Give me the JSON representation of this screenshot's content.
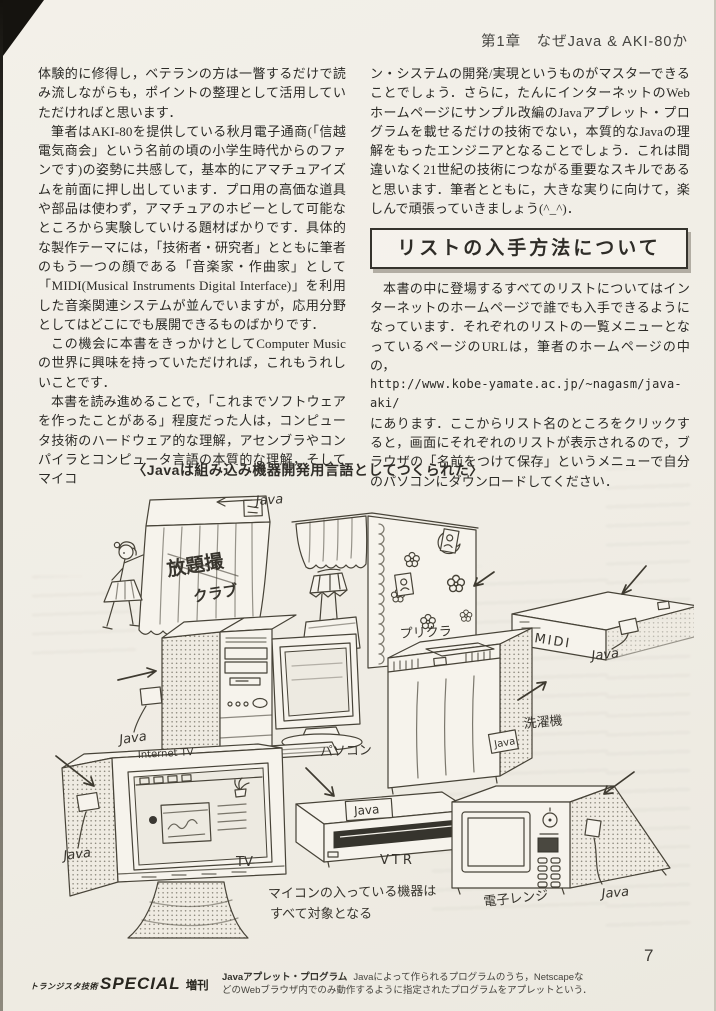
{
  "header": {
    "chapter": "第1章　なぜJava & AKI-80か"
  },
  "left_column": {
    "p1": "体験的に修得し，ベテランの方は一瞥するだけで読み流しながらも，ポイントの整理として活用していただければと思います．",
    "p2": "筆者はAKI-80を提供している秋月電子通商(「信越電気商会」という名前の頃の小学生時代からのファンです)の姿勢に共感して，基本的にアマチュアイズムを前面に押し出しています．プロ用の高価な道具や部品は使わず，アマチュアのホビーとして可能なところから実験していける題材ばかりです．具体的な製作テーマには，「技術者・研究者」とともに筆者のもう一つの顔である「音楽家・作曲家」として「MIDI(Musical Instruments Digital Interface)」を利用した音楽関連システムが並んでいますが，応用分野としてはどこにでも展開できるものばかりです．",
    "p3": "この機会に本書をきっかけとしてComputer Musicの世界に興味を持っていただければ，これもうれしいことです．",
    "p4": "本書を読み進めることで，「これまでソフトウェアを作ったことがある」程度だった人は，コンピュータ技術のハードウェア的な理解，アセンブラやコンパイラとコンピュータ言語の本質的な理解，そしてマイコ"
  },
  "right_column": {
    "p1": "ン・システムの開発/実現というものがマスターできることでしょう．さらに，たんにインターネットのWebホームページにサンプル改編のJavaアプレット・プログラムを載せるだけの技術でない，本質的なJavaの理解をもったエンジニアとなることでしょう．これは間違いなく21世紀の技術につながる重要なスキルであると思います．筆者とともに，大きな実りに向けて，楽しんで頑張っていきましょう(^_^)．",
    "box_title": "リストの入手方法について",
    "p2": "本書の中に登場するすべてのリストについてはインターネットのホームページで誰でも入手できるようになっています．それぞれのリストの一覧メニューとなっているページのURLは，筆者のホームページの中の，",
    "url": "http://www.kobe-yamate.ac.jp/~nagasm/java-aki/",
    "p3": "にあります．ここからリスト名のところをクリックすると，画面にそれぞれのリストが表示されるので，ブラウザの「名前をつけて保存」というメニューで自分のパソコンにダウンロードしてください．"
  },
  "illustration": {
    "caption": "〈Javaは組み込み機器開発用言語としてつくられた〉",
    "java_tag": "Java",
    "booth_sign": [
      "放題撮",
      "クラブ"
    ],
    "labels": {
      "purikura": "プリクラ",
      "midi": "MIDI",
      "pc": "パソコン",
      "washer": "洗濯機",
      "internet_tv": "Internet TV",
      "tv": "TV",
      "vtr": "VTR",
      "microwave": "電子レンジ"
    },
    "note": [
      "マイコンの入っている機器は",
      "すべて対象となる"
    ]
  },
  "footer": {
    "magazine": "トランジスタ技術",
    "special": "SPECIAL",
    "extra": "増刊",
    "note_term": "Javaアプレット・プログラム",
    "note_line1": "Javaによって作られるプログラムのうち，Netscapeな",
    "note_line2": "どのWebブラウザ内でのみ動作するように指定されたプログラムをアプレットという．",
    "page_number": "7"
  }
}
